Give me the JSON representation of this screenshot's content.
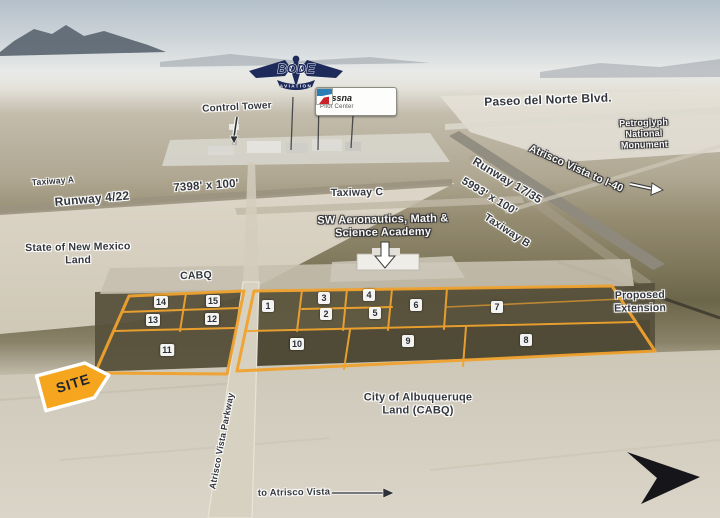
{
  "scene": "Annotated aerial photograph of airport land parcels for sale",
  "colors": {
    "parcel_outline": "#F0A32E",
    "site_tag_fill": "#F5A61E",
    "label_dark": "#33373D",
    "label_light": "#FBFBF8",
    "bode_navy": "#1D2A5A",
    "compass_dark": "#16161A"
  },
  "signs": {
    "bode": {
      "name": "BODE",
      "subtitle": "AVIATION"
    },
    "cessna": {
      "line1": "Cessna",
      "line2": "Pilot Center"
    }
  },
  "site_tag": {
    "label": "SITE"
  },
  "map_labels": [
    {
      "id": "label-control-tower",
      "text": "Control Tower",
      "x": 237,
      "y": 108,
      "rot": -3,
      "style": "dark",
      "size": 10
    },
    {
      "id": "label-paseo-del-norte",
      "text": "Paseo del Norte Blvd.",
      "x": 548,
      "y": 100,
      "rot": -2,
      "style": "dark",
      "size": 12
    },
    {
      "id": "label-petroglyph",
      "text": "Petroglyph\nNational Monument",
      "x": 644,
      "y": 134,
      "rot": -2,
      "style": "white",
      "size": 9
    },
    {
      "id": "label-atrisco-to-i40",
      "text": "Atrisco Vista to I-40",
      "x": 576,
      "y": 169,
      "rot": 24,
      "style": "white",
      "size": 10.5
    },
    {
      "id": "label-runway-17-35",
      "text": "Runway 17/35",
      "x": 507,
      "y": 181,
      "rot": 31,
      "style": "dark",
      "size": 11.5
    },
    {
      "id": "label-runway-17-35-dim",
      "text": "5993' x 100'",
      "x": 489,
      "y": 197,
      "rot": 31,
      "style": "dark",
      "size": 11
    },
    {
      "id": "label-taxiway-b",
      "text": "Taxiway B",
      "x": 507,
      "y": 231,
      "rot": 33,
      "style": "dark",
      "size": 10.5
    },
    {
      "id": "label-taxiway-a",
      "text": "Taxiway A",
      "x": 53,
      "y": 181,
      "rot": -4,
      "style": "dark",
      "size": 8.5
    },
    {
      "id": "label-runway-4-22",
      "text": "Runway 4/22",
      "x": 92,
      "y": 199,
      "rot": -5,
      "style": "dark",
      "size": 12
    },
    {
      "id": "label-runway-4-22-dim",
      "text": "7398' x 100'",
      "x": 206,
      "y": 186,
      "rot": -4,
      "style": "dark",
      "size": 11.5
    },
    {
      "id": "label-taxiway-c",
      "text": "Taxiway C",
      "x": 357,
      "y": 193,
      "rot": -1,
      "style": "dark",
      "size": 10.5
    },
    {
      "id": "label-sw-academy",
      "text": "SW Aeronautics, Math &\nScience Academy",
      "x": 383,
      "y": 227,
      "rot": -1,
      "style": "white",
      "size": 11
    },
    {
      "id": "label-state-nm",
      "text": "State of New Mexico\nLand",
      "x": 78,
      "y": 254,
      "rot": -1,
      "style": "dark",
      "size": 10.5
    },
    {
      "id": "label-cabq",
      "text": "CABQ",
      "x": 196,
      "y": 276,
      "rot": -2,
      "style": "dark",
      "size": 10.5
    },
    {
      "id": "label-proposed-extension",
      "text": "Proposed\nExtension",
      "x": 640,
      "y": 302,
      "rot": -1,
      "style": "dark",
      "size": 10.5
    },
    {
      "id": "label-city-abq",
      "text": "City of Albuqueruqe\nLand (CABQ)",
      "x": 418,
      "y": 405,
      "rot": 0,
      "style": "dark",
      "size": 11
    },
    {
      "id": "label-atrisco-parkway",
      "text": "Atrisco Vista Parkway",
      "x": 222,
      "y": 441,
      "rot": -79,
      "style": "dark",
      "size": 9
    },
    {
      "id": "label-to-atrisco",
      "text": "to Atrisco Vista",
      "x": 294,
      "y": 493,
      "rot": -1,
      "style": "dark",
      "size": 9.5
    }
  ],
  "parcels": {
    "outline_color": "#F0A32E",
    "markers": [
      {
        "n": "14",
        "x": 161,
        "y": 302
      },
      {
        "n": "15",
        "x": 213,
        "y": 301
      },
      {
        "n": "13",
        "x": 153,
        "y": 320
      },
      {
        "n": "12",
        "x": 212,
        "y": 319
      },
      {
        "n": "11",
        "x": 167,
        "y": 350
      },
      {
        "n": "1",
        "x": 268,
        "y": 306
      },
      {
        "n": "3",
        "x": 324,
        "y": 298
      },
      {
        "n": "2",
        "x": 326,
        "y": 314
      },
      {
        "n": "4",
        "x": 369,
        "y": 295
      },
      {
        "n": "5",
        "x": 375,
        "y": 313
      },
      {
        "n": "6",
        "x": 416,
        "y": 305
      },
      {
        "n": "7",
        "x": 497,
        "y": 307
      },
      {
        "n": "10",
        "x": 297,
        "y": 344
      },
      {
        "n": "9",
        "x": 408,
        "y": 341
      },
      {
        "n": "8",
        "x": 526,
        "y": 340
      }
    ]
  }
}
